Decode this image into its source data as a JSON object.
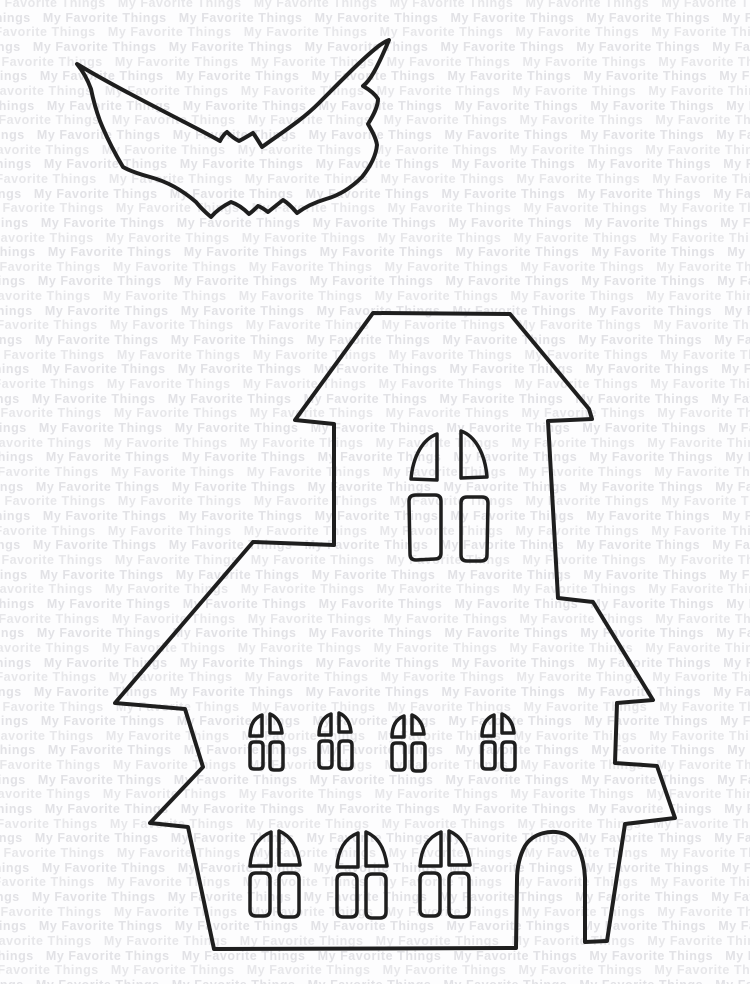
{
  "canvas": {
    "width_px": 750,
    "height_px": 984,
    "background_color": "#fdfdfe"
  },
  "watermark": {
    "phrase": "My Favorite Things",
    "rows": 69,
    "repeats_per_row": 8,
    "color_even": "#e7e7ea",
    "color_odd": "#e2e2e6"
  },
  "die_cuts": {
    "stroke_color": "#1e1e1e",
    "bat": {
      "label": "bat silhouette die-cut outline",
      "path": "M 77 64 C 95 75 128 93 163 111 C 186 123 206 133 220 141 C 222 137 224 134 227 132 C 231 136 235 139 239 141 C 243 139 248 136 253 133 C 256 137 259 142 262 147 C 281 133 301 121 319 103 C 341 81 363 58 380 45 C 383 43 386 41 389 40 C 384 52 379 63 374 72 C 370 79 367 83 363 86 C 370 90 375 94 378 99 C 378 107 373 116 368 124 C 372 131 376 138 377 145 C 376 156 370 167 362 177 C 349 190 337 196 326 199 C 316 202 305 207 297 213 C 292 207 288 203 283 200 C 278 204 273 208 268 212 C 264 209 261 207 258 206 C 255 209 252 212 249 214 C 243 208 237 204 231 202 C 223 206 216 211 211 217 C 205 212 200 207 196 202 C 181 189 165 181 150 177 C 139 174 130 171 123 167 C 114 152 106 136 100 121 C 96 110 93 99 91 89 C 87 78 82 70 77 64 Z"
    },
    "house": {
      "label": "haunted house silhouette die-cut outline",
      "outline_path": "M 373 313 L 510 314 L 589 409 L 592 419 L 548 421 L 558 598 L 593 602 L 653 700 L 617 703 L 615 763 L 657 766 L 675 818 L 625 824 L 607 941 L 585 942 L 585 878 C 584 856 577 840 565 834 C 551 829 533 833 525 846 C 520 855 517 866 517 880 L 516 948 L 214 949 L 188 827 L 150 823 L 203 767 L 185 709 L 115 703 L 253 542 L 334 545 L 334 424 L 295 420 Z",
      "tower_window": {
        "label": "tall arched tower window with four panes",
        "panes": [
          "M 437 434 C 423 439 413 456 411 479 L 437 480 Z",
          "M 461 431 C 475 436 485 453 487 477 L 461 478 Z",
          "M 416 495 L 435 495 Q 441 495 441 501 L 441 553 Q 441 559 435 559 L 416 560 Q 410 560 410 554 L 409 501 Q 409 495 416 495 Z",
          "M 467 497 L 482 497 Q 488 497 488 503 L 487 555 Q 487 561 481 561 L 467 561 Q 461 561 461 555 L 461 503 Q 461 497 467 497 Z"
        ]
      },
      "small_windows": {
        "label": "row of four small four-pane windows",
        "positions": [
          {
            "x": 248,
            "y": 712
          },
          {
            "x": 317,
            "y": 711
          },
          {
            "x": 390,
            "y": 713
          },
          {
            "x": 480,
            "y": 712
          }
        ],
        "panes": [
          "M 14 3 C 6 6 2 13 2 24 L 14 24 Z",
          "M 22 2 C 29 5 33 11 34 21 L 22 21 Z",
          "M 6 30 L 11 30 Q 15 30 15 34 L 15 53 Q 15 57 11 57 L 6 57 Q 2 57 2 53 L 2 34 Q 2 30 6 30 Z",
          "M 26 30 L 31 30 Q 35 30 35 34 L 35 54 Q 35 58 31 58 L 26 58 Q 22 58 22 54 L 22 34 Q 22 30 26 30 Z"
        ]
      },
      "large_windows": {
        "label": "row of three large four-pane windows",
        "positions": [
          {
            "x": 248,
            "y": 829
          },
          {
            "x": 335,
            "y": 830
          },
          {
            "x": 418,
            "y": 829
          }
        ],
        "panes": [
          "M 23 3 C 10 8 3 20 2 37 L 23 37 Z",
          "M 31 2 C 43 7 50 19 52 36 L 31 36 Z",
          "M 8 44 L 16 44 Q 22 44 22 50 L 22 81 Q 22 87 16 87 L 8 87 Q 2 87 2 81 L 2 50 Q 2 44 8 44 Z",
          "M 37 44 L 45 44 Q 51 44 51 50 L 51 82 Q 51 88 45 88 L 37 88 Q 31 88 31 82 L 31 50 Q 31 44 37 44 Z"
        ]
      }
    }
  }
}
